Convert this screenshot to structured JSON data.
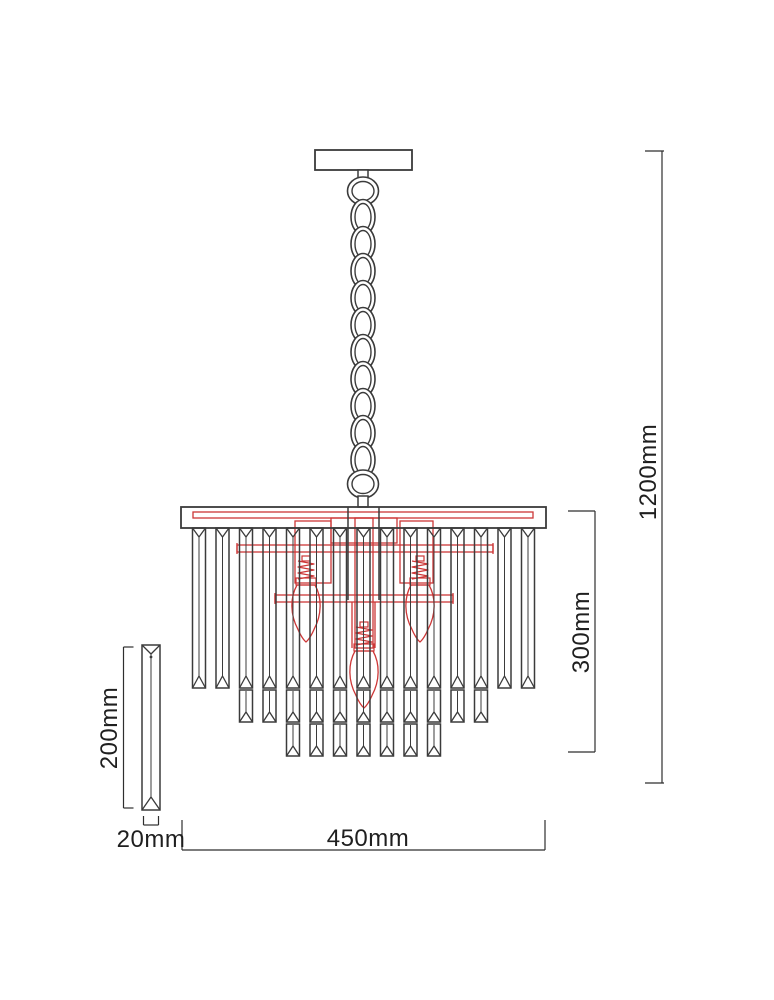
{
  "diagram": {
    "kind": "technical dimension drawing",
    "subject": "crystal chandelier with ceiling plate, suspension chain, tiered crystal prisms and three candle bulbs",
    "background_color": "#ffffff",
    "line_color": "#3b3b3b",
    "dimension_line_color": "#2e2e2e",
    "accent_color": "#cd3737",
    "text_color": "#1f1f1f"
  },
  "dimensions": {
    "overall_height": {
      "label": "1200mm",
      "value_mm": 1200,
      "orientation": "vertical",
      "measures": "overall hanging height"
    },
    "body_height": {
      "label": "300mm",
      "value_mm": 300,
      "orientation": "vertical",
      "measures": "chandelier body height"
    },
    "body_width": {
      "label": "450mm",
      "value_mm": 450,
      "orientation": "horizontal",
      "measures": "chandelier body width"
    },
    "crystal_length": {
      "label": "200mm",
      "value_mm": 200,
      "orientation": "vertical",
      "measures": "single crystal prism length"
    },
    "crystal_width": {
      "label": "20mm",
      "value_mm": 20,
      "orientation": "horizontal",
      "measures": "single crystal prism width"
    }
  },
  "components": {
    "ceiling_plate_count": 1,
    "chain_link_count": 10,
    "crystal_column_count": 15,
    "crystal_tier_count": 3,
    "tier2_column_range": [
      3,
      13
    ],
    "tier3_column_range": [
      5,
      11
    ],
    "bulb_count": 3,
    "detail_crystal_count": 1
  }
}
